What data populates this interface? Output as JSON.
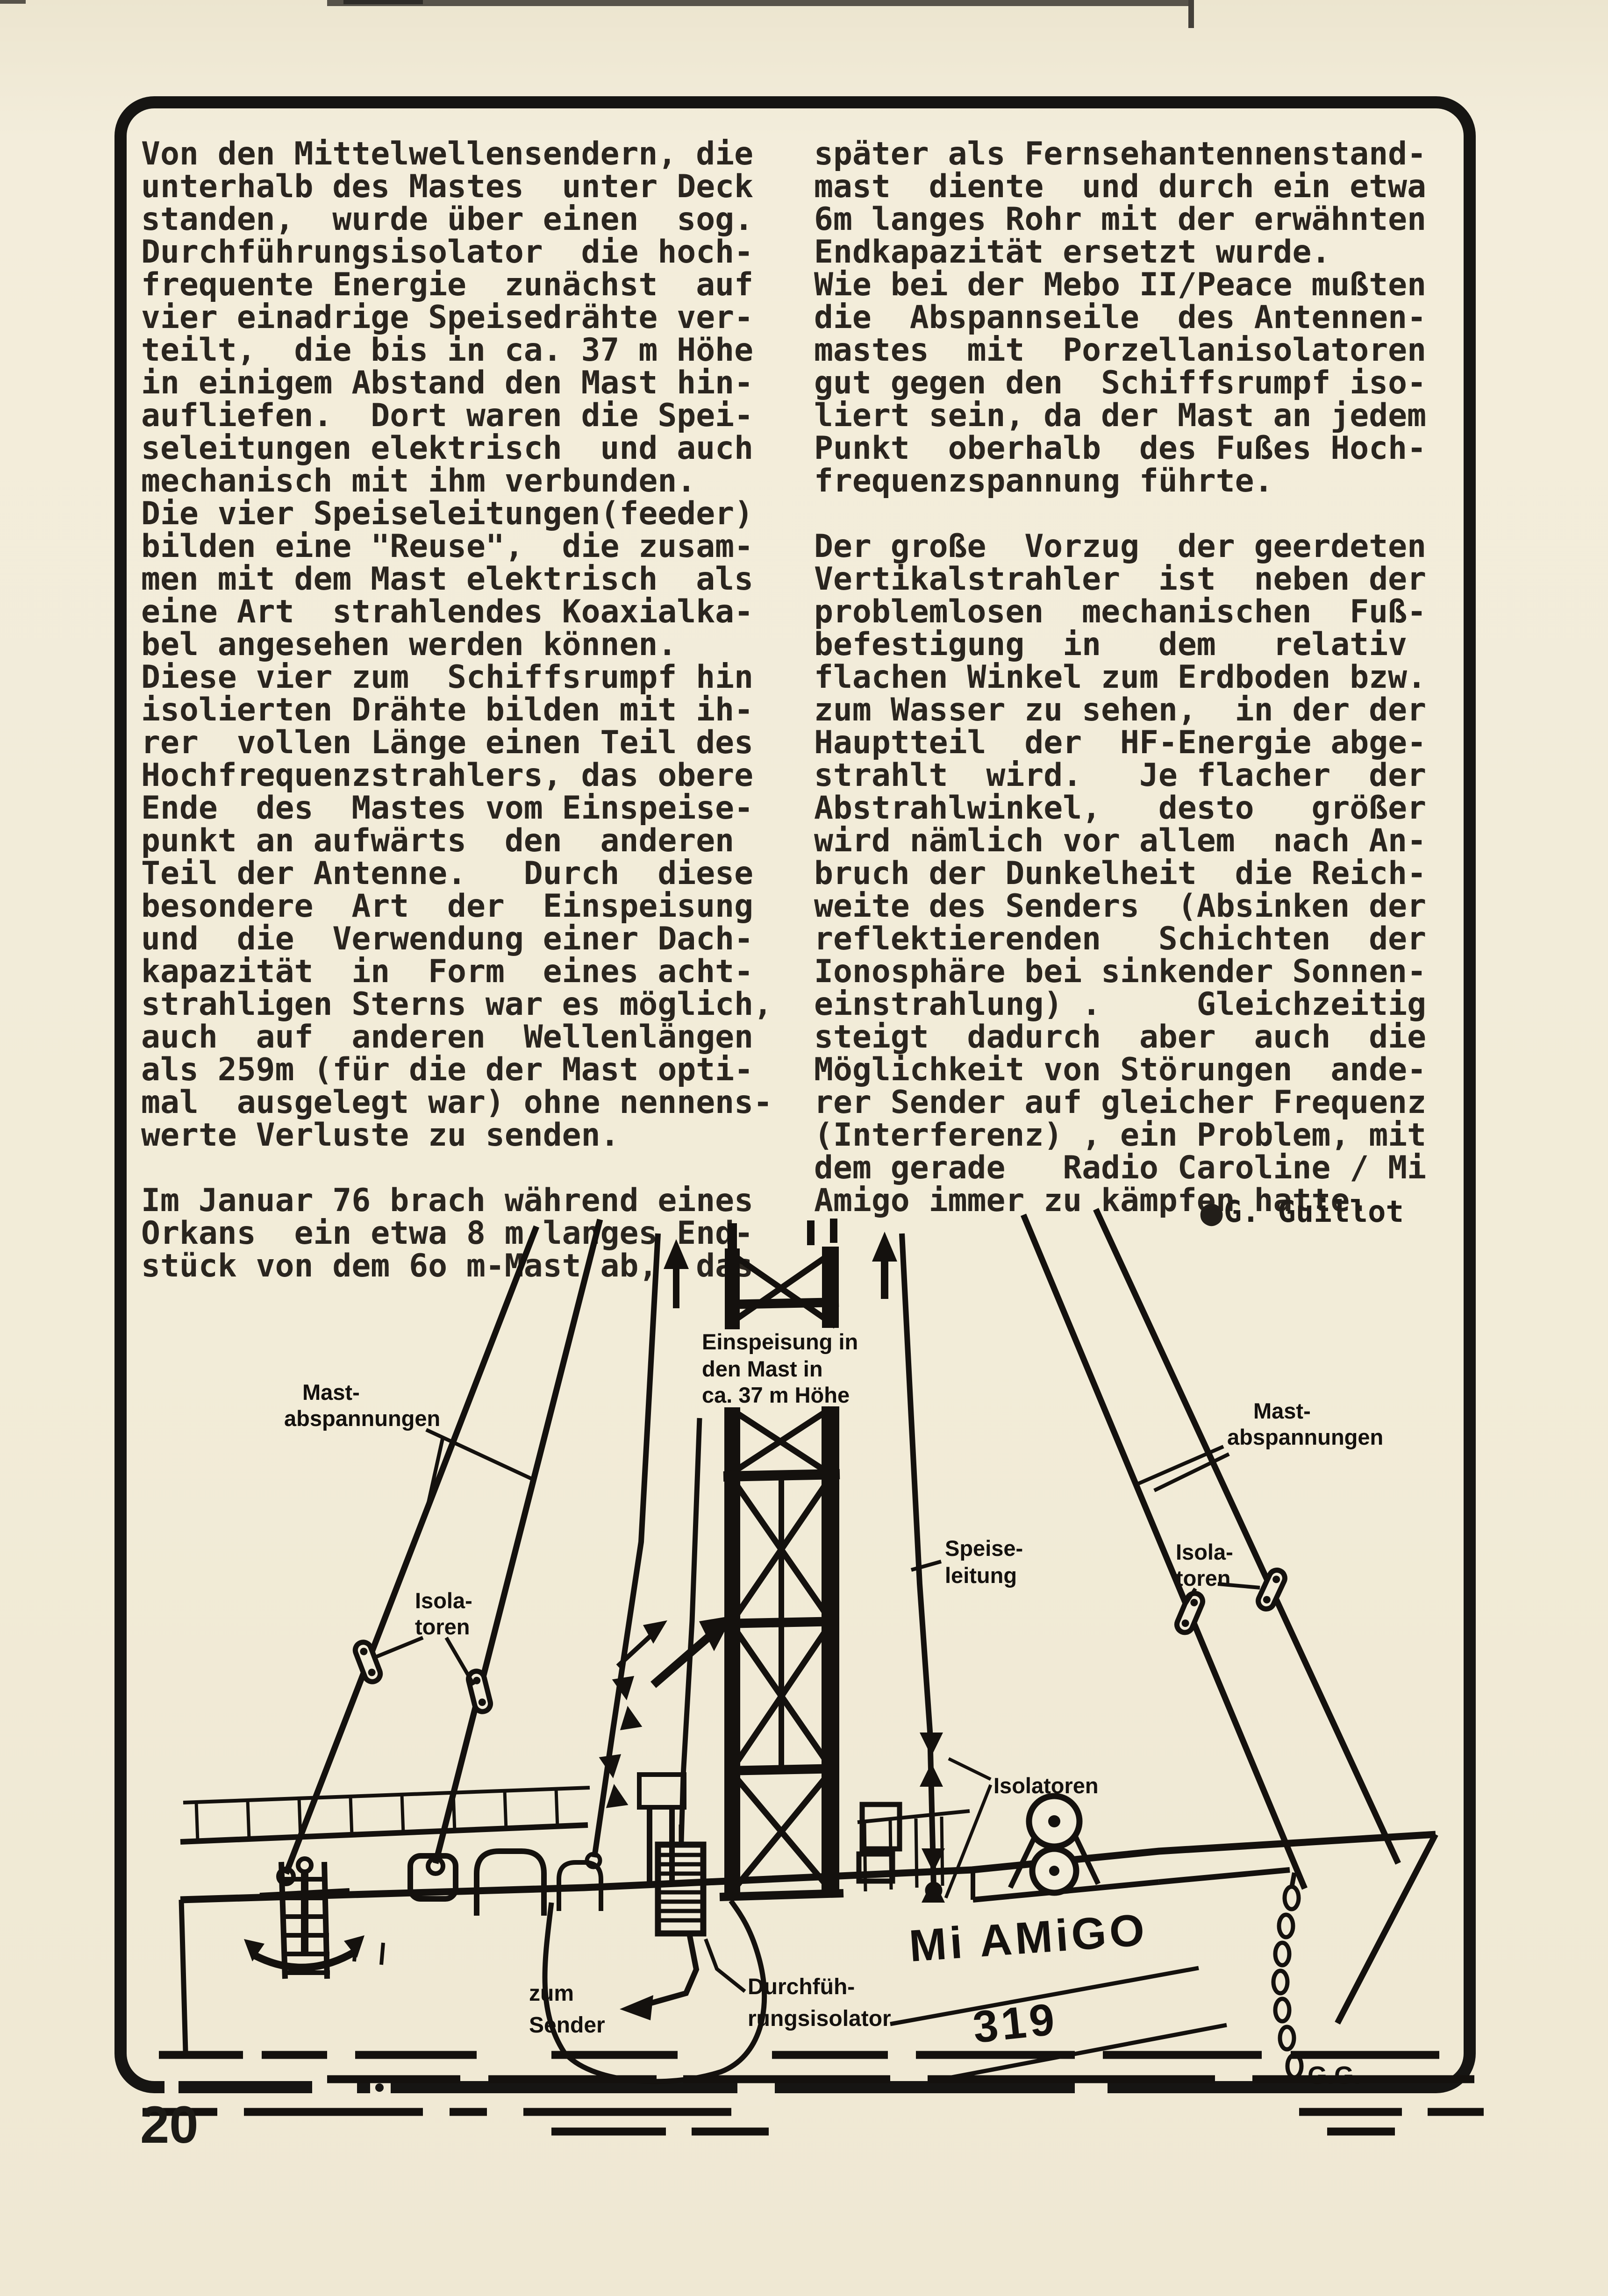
{
  "page": {
    "number": "20"
  },
  "article": {
    "column_left": {
      "lines": [
        "Von den Mittelwellensendern, die",
        "unterhalb des Mastes  unter Deck",
        "standen,  wurde über einen  sog.",
        "Durchführungsisolator  die hoch-",
        "frequente Energie  zunächst  auf",
        "vier einadrige Speisedrähte ver-",
        "teilt,  die bis in ca. 37 m Höhe",
        "in einigem Abstand den Mast hin-",
        "aufliefen.  Dort waren die Spei-",
        "seleitungen elektrisch  und auch",
        "mechanisch mit ihm verbunden.",
        "Die vier Speiseleitungen(feeder)",
        "bilden eine \"Reuse\",  die zusam-",
        "men mit dem Mast elektrisch  als",
        "eine Art  strahlendes Koaxialka-",
        "bel angesehen werden können.",
        "Diese vier zum  Schiffsrumpf hin",
        "isolierten Drähte bilden mit ih-",
        "rer  vollen Länge einen Teil des",
        "Hochfrequenzstrahlers, das obere",
        "Ende  des  Mastes vom Einspeise-",
        "punkt an aufwärts  den  anderen",
        "Teil der Antenne.   Durch  diese",
        "besondere  Art  der  Einspeisung",
        "und  die  Verwendung einer Dach-",
        "kapazität  in  Form  eines acht-",
        "strahligen Sterns war es möglich,",
        "auch  auf  anderen  Wellenlängen",
        "als 259m (für die der Mast opti-",
        "mal  ausgelegt war) ohne nennens-",
        "werte Verluste zu senden.",
        "",
        "Im Januar 76 brach während eines",
        "Orkans  ein etwa 8 m langes End-",
        "stück von dem 6o m-Mast ab,  das"
      ]
    },
    "column_right": {
      "lines": [
        "später als Fernsehantennenstand-",
        "mast  diente  und durch ein etwa",
        "6m langes Rohr mit der erwähnten",
        "Endkapazität ersetzt wurde.",
        "Wie bei der Mebo II/Peace mußten",
        "die  Abspannseile  des Antennen-",
        "mastes  mit  Porzellanisolatoren",
        "gut gegen den  Schiffsrumpf iso-",
        "liert sein, da der Mast an jedem",
        "Punkt  oberhalb  des Fußes Hoch-",
        "frequenzspannung führte.",
        "",
        "Der große  Vorzug  der geerdeten",
        "Vertikalstrahler  ist  neben der",
        "problemlosen  mechanischen  Fuß-",
        "befestigung  in   dem   relativ",
        "flachen Winkel zum Erdboden bzw.",
        "zum Wasser zu sehen,  in der der",
        "Hauptteil  der  HF-Energie abge-",
        "strahlt  wird.   Je flacher  der",
        "Abstrahlwinkel,   desto   größer",
        "wird nämlich vor allem  nach An-",
        "bruch der Dunkelheit  die Reich-",
        "weite des Senders  (Absinken der",
        "reflektierenden   Schichten  der",
        "Ionosphäre bei sinkender Sonnen-",
        "einstrahlung) .     Gleichzeitig",
        "steigt  dadurch  aber  auch  die",
        "Möglichkeit von Störungen  ande-",
        "rer Sender auf gleicher Frequenz",
        "(Interferenz) , ein Problem, mit",
        "dem gerade   Radio Caroline / Mi",
        "Amigo immer zu kämpfen hatte."
      ]
    },
    "byline": {
      "bullet": "●",
      "author": "G. Guillot"
    }
  },
  "diagram": {
    "labels": {
      "einspeisung": [
        "Einspeisung in",
        "den Mast in",
        "ca. 37 m Höhe"
      ],
      "mast_abspannungen_left": [
        "Mast-",
        "abspannungen"
      ],
      "mast_abspannungen_right": [
        "Mast-",
        "abspannungen"
      ],
      "isolatoren_left": [
        "Isola-",
        "toren"
      ],
      "isolatoren_right": [
        "Isola-",
        "toren"
      ],
      "isolatoren_center": "Isolatoren",
      "speiseleitung": [
        "Speise-",
        "leitung"
      ],
      "zum_sender": [
        "zum",
        "Sender"
      ],
      "durchfuehrungsisolator": [
        "Durchfüh-",
        "rungsisolator"
      ],
      "ship_name": "Mi AMiGO",
      "ship_number": "319",
      "artist_initials": "G.G."
    }
  },
  "colors": {
    "paper": "#f2ecd9",
    "typewriter_ink": "#2a251f",
    "diagram_ink": "#14110e"
  }
}
